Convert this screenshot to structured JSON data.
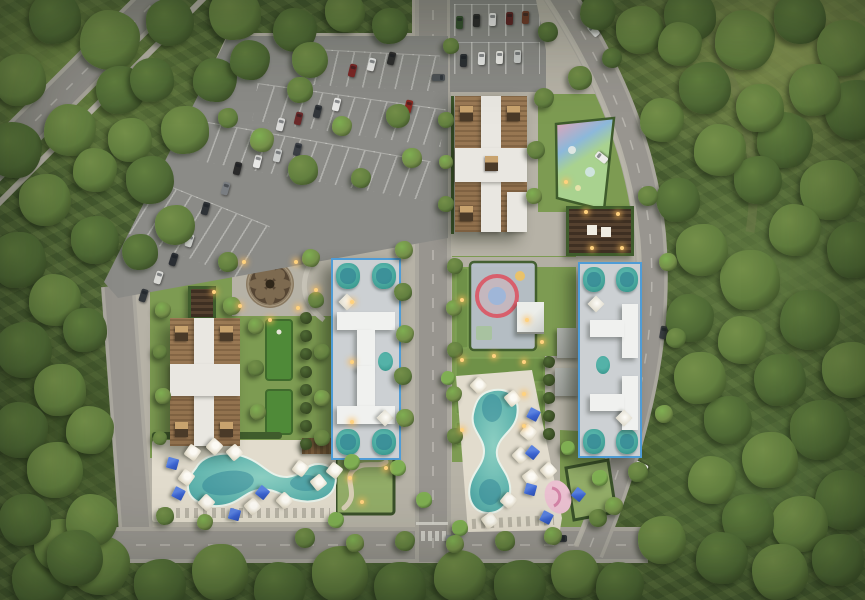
{
  "meta": {
    "scene": "aerial-masterplan-render",
    "visible_text": []
  },
  "colors": {
    "forest_base": "#4c6234",
    "grass": "#7d9b52",
    "lawn": "#6f9148",
    "turf": "#4f8a38",
    "hedge": "#3f5c2c",
    "paving": "#b6b2a6",
    "sidewalk": "#bdb9ad",
    "road": "#98958f",
    "road_edge": "#aaa79e",
    "asphalt": "#8b8b87",
    "roof_brown": "#9b7a55",
    "roof_white": "#e9e7e1",
    "roof_dark_unit": "#4a3a28",
    "unit_tan": "#c8a36e",
    "blue_outline": "#4f9cd6",
    "bldg_fill": "#ccd0d3",
    "bldg_white": "#f0f1ef",
    "teal": "#3f9e94",
    "teal_dark": "#2d7c90",
    "pool_light": "#9ed2c6",
    "pool_mid": "#5fb3ad",
    "pool_deep": "#2f8496",
    "deck": "#e2dccd",
    "umbrella_white": "#f2efe7",
    "umbrella_blue": "#3b63cf",
    "playground_pink": "#e9a2b4",
    "playground_red": "#d85f6c",
    "playground_blue": "#8cb8da",
    "playground_green": "#a9d28f",
    "playground_base": "#b7bfca",
    "pergola": "#453527",
    "light_warm": "#ffd27e",
    "tree_tones": [
      "#3c5026",
      "#4f6a35",
      "#627f3f",
      "#748f49",
      "#7fae52"
    ]
  },
  "site": {
    "buildings": [
      {
        "name": "north-residential-building",
        "roof": "brown-tile",
        "highlighted": false
      },
      {
        "name": "west-residential-building",
        "roof": "brown-tile",
        "highlighted": false
      },
      {
        "name": "central-residential-building",
        "roof": "white-gray",
        "highlighted": true,
        "outline": "#4f9cd6"
      },
      {
        "name": "east-residential-building",
        "roof": "white-gray",
        "highlighted": true,
        "outline": "#4f9cd6"
      }
    ],
    "amenities": [
      "circular-plaza",
      "mini-golf-lawn",
      "children-playground-triangle",
      "children-playground-ring",
      "pergola-lounge",
      "west-pool",
      "south-pool",
      "sun-decks",
      "secret-garden",
      "pool-bar"
    ],
    "parking": [
      "northwest-lot",
      "north-lot"
    ],
    "trees": [
      [
        55,
        18,
        26,
        1
      ],
      [
        110,
        40,
        30,
        2
      ],
      [
        170,
        22,
        24,
        1
      ],
      [
        235,
        14,
        26,
        2
      ],
      [
        295,
        30,
        22,
        1
      ],
      [
        345,
        12,
        20,
        2
      ],
      [
        390,
        26,
        18,
        1
      ],
      [
        598,
        12,
        18,
        1
      ],
      [
        640,
        30,
        24,
        2
      ],
      [
        690,
        16,
        26,
        1
      ],
      [
        745,
        40,
        30,
        2
      ],
      [
        800,
        18,
        26,
        1
      ],
      [
        845,
        48,
        28,
        2
      ],
      [
        680,
        44,
        22,
        2
      ],
      [
        855,
        110,
        30,
        1
      ],
      [
        815,
        90,
        26,
        2
      ],
      [
        785,
        140,
        28,
        1
      ],
      [
        830,
        190,
        30,
        2
      ],
      [
        855,
        250,
        28,
        1
      ],
      [
        795,
        230,
        26,
        2
      ],
      [
        758,
        180,
        24,
        1
      ],
      [
        750,
        280,
        30,
        2
      ],
      [
        810,
        320,
        30,
        1
      ],
      [
        850,
        370,
        28,
        2
      ],
      [
        780,
        380,
        26,
        1
      ],
      [
        742,
        340,
        24,
        2
      ],
      [
        820,
        430,
        30,
        1
      ],
      [
        770,
        460,
        28,
        2
      ],
      [
        845,
        500,
        30,
        1
      ],
      [
        800,
        524,
        28,
        2
      ],
      [
        748,
        520,
        26,
        1
      ],
      [
        712,
        480,
        24,
        2
      ],
      [
        728,
        420,
        24,
        1
      ],
      [
        700,
        378,
        26,
        2
      ],
      [
        690,
        318,
        24,
        1
      ],
      [
        702,
        250,
        26,
        2
      ],
      [
        678,
        200,
        22,
        1
      ],
      [
        662,
        120,
        22,
        2
      ],
      [
        705,
        88,
        26,
        1
      ],
      [
        760,
        108,
        24,
        2
      ],
      [
        720,
        150,
        26,
        2
      ],
      [
        838,
        560,
        26,
        1
      ],
      [
        780,
        572,
        28,
        2
      ],
      [
        722,
        558,
        26,
        1
      ],
      [
        662,
        540,
        24,
        2
      ],
      [
        40,
        580,
        28,
        1
      ],
      [
        100,
        565,
        30,
        2
      ],
      [
        160,
        585,
        26,
        1
      ],
      [
        220,
        572,
        28,
        2
      ],
      [
        280,
        588,
        26,
        1
      ],
      [
        340,
        574,
        28,
        2
      ],
      [
        400,
        588,
        26,
        1
      ],
      [
        460,
        576,
        26,
        2
      ],
      [
        520,
        586,
        26,
        1
      ],
      [
        575,
        574,
        24,
        2
      ],
      [
        620,
        586,
        24,
        1
      ],
      [
        60,
        545,
        26,
        2
      ],
      [
        20,
        80,
        26,
        2
      ],
      [
        14,
        150,
        28,
        1
      ],
      [
        45,
        200,
        26,
        2
      ],
      [
        18,
        260,
        28,
        1
      ],
      [
        55,
        300,
        26,
        2
      ],
      [
        24,
        350,
        28,
        1
      ],
      [
        60,
        390,
        26,
        2
      ],
      [
        20,
        430,
        28,
        1
      ],
      [
        55,
        470,
        28,
        2
      ],
      [
        25,
        520,
        26,
        1
      ],
      [
        92,
        520,
        26,
        2
      ],
      [
        75,
        558,
        28,
        1
      ],
      [
        120,
        90,
        24,
        1
      ],
      [
        70,
        130,
        26,
        2
      ],
      [
        95,
        240,
        24,
        1
      ],
      [
        85,
        330,
        22,
        1
      ],
      [
        90,
        430,
        24,
        2
      ],
      [
        130,
        140,
        22,
        2
      ],
      [
        152,
        80,
        22,
        1
      ],
      [
        95,
        170,
        22,
        2
      ],
      [
        150,
        180,
        24,
        1
      ],
      [
        185,
        130,
        24,
        2
      ],
      [
        215,
        80,
        22,
        1
      ],
      [
        175,
        225,
        20,
        2
      ],
      [
        140,
        252,
        18,
        1
      ],
      [
        250,
        60,
        20,
        1
      ],
      [
        310,
        60,
        18,
        2
      ],
      [
        300,
        90,
        13,
        2
      ],
      [
        262,
        140,
        12,
        3
      ],
      [
        228,
        118,
        10,
        2
      ],
      [
        303,
        170,
        15,
        2
      ],
      [
        342,
        126,
        10,
        3
      ],
      [
        398,
        116,
        12,
        2
      ],
      [
        412,
        158,
        10,
        3
      ],
      [
        361,
        178,
        10,
        2
      ],
      [
        404,
        250,
        9,
        3
      ],
      [
        403,
        292,
        9,
        2
      ],
      [
        405,
        334,
        9,
        3
      ],
      [
        403,
        376,
        9,
        2
      ],
      [
        405,
        418,
        9,
        3
      ],
      [
        455,
        266,
        8,
        2
      ],
      [
        454,
        308,
        8,
        3
      ],
      [
        455,
        350,
        8,
        2
      ],
      [
        454,
        394,
        8,
        3
      ],
      [
        455,
        436,
        8,
        2
      ],
      [
        228,
        262,
        10,
        2
      ],
      [
        311,
        258,
        9,
        3
      ],
      [
        232,
        306,
        9,
        3
      ],
      [
        316,
        300,
        8,
        2
      ],
      [
        256,
        326,
        8,
        3
      ],
      [
        322,
        352,
        8,
        2
      ],
      [
        256,
        368,
        8,
        2
      ],
      [
        322,
        398,
        8,
        3
      ],
      [
        258,
        412,
        8,
        3
      ],
      [
        322,
        438,
        8,
        2
      ],
      [
        163,
        310,
        8,
        3
      ],
      [
        160,
        352,
        7,
        2
      ],
      [
        163,
        396,
        8,
        3
      ],
      [
        160,
        438,
        7,
        2
      ],
      [
        446,
        120,
        8,
        2
      ],
      [
        446,
        162,
        7,
        3
      ],
      [
        446,
        204,
        8,
        2
      ],
      [
        536,
        150,
        9,
        2
      ],
      [
        534,
        196,
        8,
        3
      ],
      [
        544,
        98,
        10,
        2
      ],
      [
        548,
        32,
        10,
        1
      ],
      [
        451,
        46,
        8,
        2
      ],
      [
        352,
        462,
        8,
        4
      ],
      [
        398,
        468,
        8,
        4
      ],
      [
        424,
        500,
        8,
        4
      ],
      [
        448,
        378,
        7,
        4
      ],
      [
        600,
        478,
        8,
        4
      ],
      [
        568,
        448,
        7,
        4
      ],
      [
        336,
        520,
        8,
        4
      ],
      [
        460,
        528,
        8,
        4
      ],
      [
        165,
        516,
        9,
        2
      ],
      [
        205,
        522,
        8,
        3
      ],
      [
        305,
        538,
        10,
        2
      ],
      [
        355,
        543,
        9,
        3
      ],
      [
        405,
        541,
        10,
        2
      ],
      [
        455,
        544,
        9,
        3
      ],
      [
        505,
        541,
        10,
        2
      ],
      [
        553,
        536,
        9,
        3
      ],
      [
        598,
        518,
        9,
        2
      ],
      [
        580,
        78,
        12,
        2
      ],
      [
        612,
        58,
        10,
        1
      ],
      [
        648,
        196,
        10,
        2
      ],
      [
        668,
        262,
        9,
        3
      ],
      [
        676,
        338,
        10,
        2
      ],
      [
        664,
        414,
        9,
        3
      ],
      [
        638,
        472,
        10,
        2
      ],
      [
        614,
        506,
        9,
        3
      ],
      [
        306,
        318,
        6,
        0
      ],
      [
        306,
        336,
        6,
        0
      ],
      [
        306,
        354,
        6,
        0
      ],
      [
        306,
        372,
        6,
        0
      ],
      [
        306,
        390,
        6,
        0
      ],
      [
        306,
        408,
        6,
        0
      ],
      [
        306,
        426,
        6,
        0
      ],
      [
        306,
        444,
        6,
        0
      ],
      [
        549,
        362,
        6,
        0
      ],
      [
        549,
        380,
        6,
        0
      ],
      [
        549,
        398,
        6,
        0
      ],
      [
        549,
        416,
        6,
        0
      ],
      [
        549,
        434,
        6,
        0
      ]
    ],
    "cars": [
      [
        352,
        70,
        14,
        "#7b2726"
      ],
      [
        371,
        64,
        14,
        "#e8e8e6"
      ],
      [
        391,
        58,
        14,
        "#2e2e2e"
      ],
      [
        336,
        104,
        14,
        "#e8e8e6"
      ],
      [
        317,
        111,
        14,
        "#32363a"
      ],
      [
        298,
        118,
        14,
        "#6b2a2a"
      ],
      [
        280,
        124,
        14,
        "#d9d9d7"
      ],
      [
        408,
        106,
        14,
        "#8c2a22"
      ],
      [
        237,
        168,
        14,
        "#2a2a2a"
      ],
      [
        257,
        161,
        14,
        "#e8e8e6"
      ],
      [
        277,
        155,
        14,
        "#c9cbc9"
      ],
      [
        297,
        149,
        14,
        "#3a3e44"
      ],
      [
        225,
        188,
        16,
        "#7a7e82"
      ],
      [
        205,
        208,
        16,
        "#2e3236"
      ],
      [
        189,
        240,
        18,
        "#caccc8"
      ],
      [
        173,
        259,
        18,
        "#2a2e33"
      ],
      [
        158,
        277,
        18,
        "#d8d8d4"
      ],
      [
        143,
        295,
        18,
        "#33373c"
      ],
      [
        459,
        22,
        2,
        "#35502f"
      ],
      [
        476,
        20,
        2,
        "#2c2c2c"
      ],
      [
        492,
        19,
        2,
        "#e8e8e6"
      ],
      [
        509,
        18,
        2,
        "#5d2424"
      ],
      [
        525,
        17,
        2,
        "#6e3b28"
      ],
      [
        463,
        60,
        2,
        "#2c3034"
      ],
      [
        481,
        58,
        2,
        "#e8e8e6"
      ],
      [
        499,
        57,
        2,
        "#ecebe7"
      ],
      [
        517,
        56,
        2,
        "#c9cbc9"
      ],
      [
        601,
        157,
        -52,
        "#ecebe9"
      ],
      [
        663,
        332,
        10,
        "#3a3e42"
      ],
      [
        438,
        77,
        90,
        "#4e5256"
      ],
      [
        452,
        538,
        90,
        "#8a8e92"
      ],
      [
        560,
        538,
        90,
        "#2e3236"
      ],
      [
        641,
        466,
        -65,
        "#e9e9e7"
      ],
      [
        593,
        30,
        -42,
        "#e9e9e7"
      ]
    ],
    "umbrellas": {
      "white": [
        [
          192,
          452
        ],
        [
          214,
          446
        ],
        [
          234,
          452
        ],
        [
          186,
          477
        ],
        [
          206,
          502
        ],
        [
          252,
          506
        ],
        [
          300,
          468
        ],
        [
          284,
          500
        ],
        [
          318,
          482
        ],
        [
          334,
          470
        ],
        [
          478,
          385
        ],
        [
          512,
          398
        ],
        [
          528,
          432
        ],
        [
          520,
          455
        ],
        [
          530,
          477
        ],
        [
          508,
          500
        ],
        [
          548,
          470
        ],
        [
          489,
          520
        ]
      ],
      "blue": [
        [
          172,
          463
        ],
        [
          178,
          493
        ],
        [
          262,
          492
        ],
        [
          234,
          514
        ],
        [
          533,
          414
        ],
        [
          532,
          452
        ],
        [
          530,
          489
        ],
        [
          546,
          517
        ],
        [
          578,
          494
        ]
      ]
    },
    "lights": [
      [
        244,
        262
      ],
      [
        296,
        262
      ],
      [
        240,
        306
      ],
      [
        298,
        308
      ],
      [
        270,
        320
      ],
      [
        352,
        302
      ],
      [
        352,
        362
      ],
      [
        352,
        422
      ],
      [
        462,
        300
      ],
      [
        462,
        360
      ],
      [
        462,
        430
      ],
      [
        586,
        212
      ],
      [
        618,
        214
      ],
      [
        592,
        248
      ],
      [
        622,
        248
      ],
      [
        566,
        182
      ],
      [
        350,
        478
      ],
      [
        362,
        502
      ],
      [
        386,
        468
      ],
      [
        527,
        320
      ],
      [
        542,
        342
      ],
      [
        214,
        292
      ],
      [
        316,
        290
      ],
      [
        524,
        362
      ],
      [
        524,
        394
      ],
      [
        524,
        426
      ],
      [
        494,
        356
      ]
    ]
  }
}
